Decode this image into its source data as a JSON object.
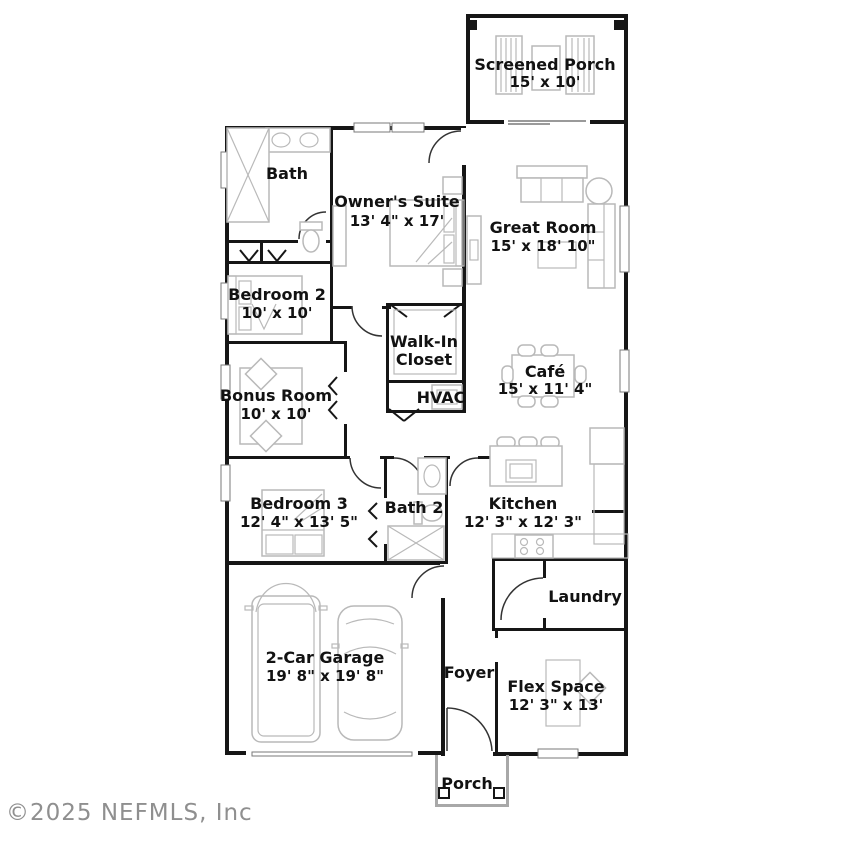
{
  "watermark": "©2025 NEFMLS, Inc",
  "colors": {
    "wall": "#161616",
    "furniture": "#b9b9b9",
    "text": "#121212",
    "watermark": "#8f8f8f",
    "background": "#ffffff"
  },
  "rooms": [
    {
      "id": "screened-porch",
      "line1": "Screened Porch",
      "line2": "15' x 10'"
    },
    {
      "id": "bath",
      "line1": "Bath",
      "line2": ""
    },
    {
      "id": "owners-suite",
      "line1": "Owner's Suite",
      "line2": "13' 4\" x 17'"
    },
    {
      "id": "great-room",
      "line1": "Great Room",
      "line2": "15' x 18' 10\""
    },
    {
      "id": "bedroom-2",
      "line1": "Bedroom 2",
      "line2": "10' x 10'"
    },
    {
      "id": "walk-in-closet",
      "line1": "Walk-In",
      "line2": "Closet"
    },
    {
      "id": "cafe",
      "line1": "Café",
      "line2": "15' x 11' 4\""
    },
    {
      "id": "bonus-room",
      "line1": "Bonus Room",
      "line2": "10' x 10'"
    },
    {
      "id": "hvac",
      "line1": "HVAC",
      "line2": ""
    },
    {
      "id": "bedroom-3",
      "line1": "Bedroom 3",
      "line2": "12' 4\" x 13' 5\""
    },
    {
      "id": "bath-2",
      "line1": "Bath 2",
      "line2": ""
    },
    {
      "id": "kitchen",
      "line1": "Kitchen",
      "line2": "12' 3\" x 12' 3\""
    },
    {
      "id": "laundry",
      "line1": "Laundry",
      "line2": ""
    },
    {
      "id": "garage",
      "line1": "2-Car Garage",
      "line2": "19' 8\" x 19' 8\""
    },
    {
      "id": "foyer",
      "line1": "Foyer",
      "line2": ""
    },
    {
      "id": "flex-space",
      "line1": "Flex Space",
      "line2": "12' 3\" x 13'"
    },
    {
      "id": "porch",
      "line1": "Porch",
      "line2": ""
    }
  ]
}
